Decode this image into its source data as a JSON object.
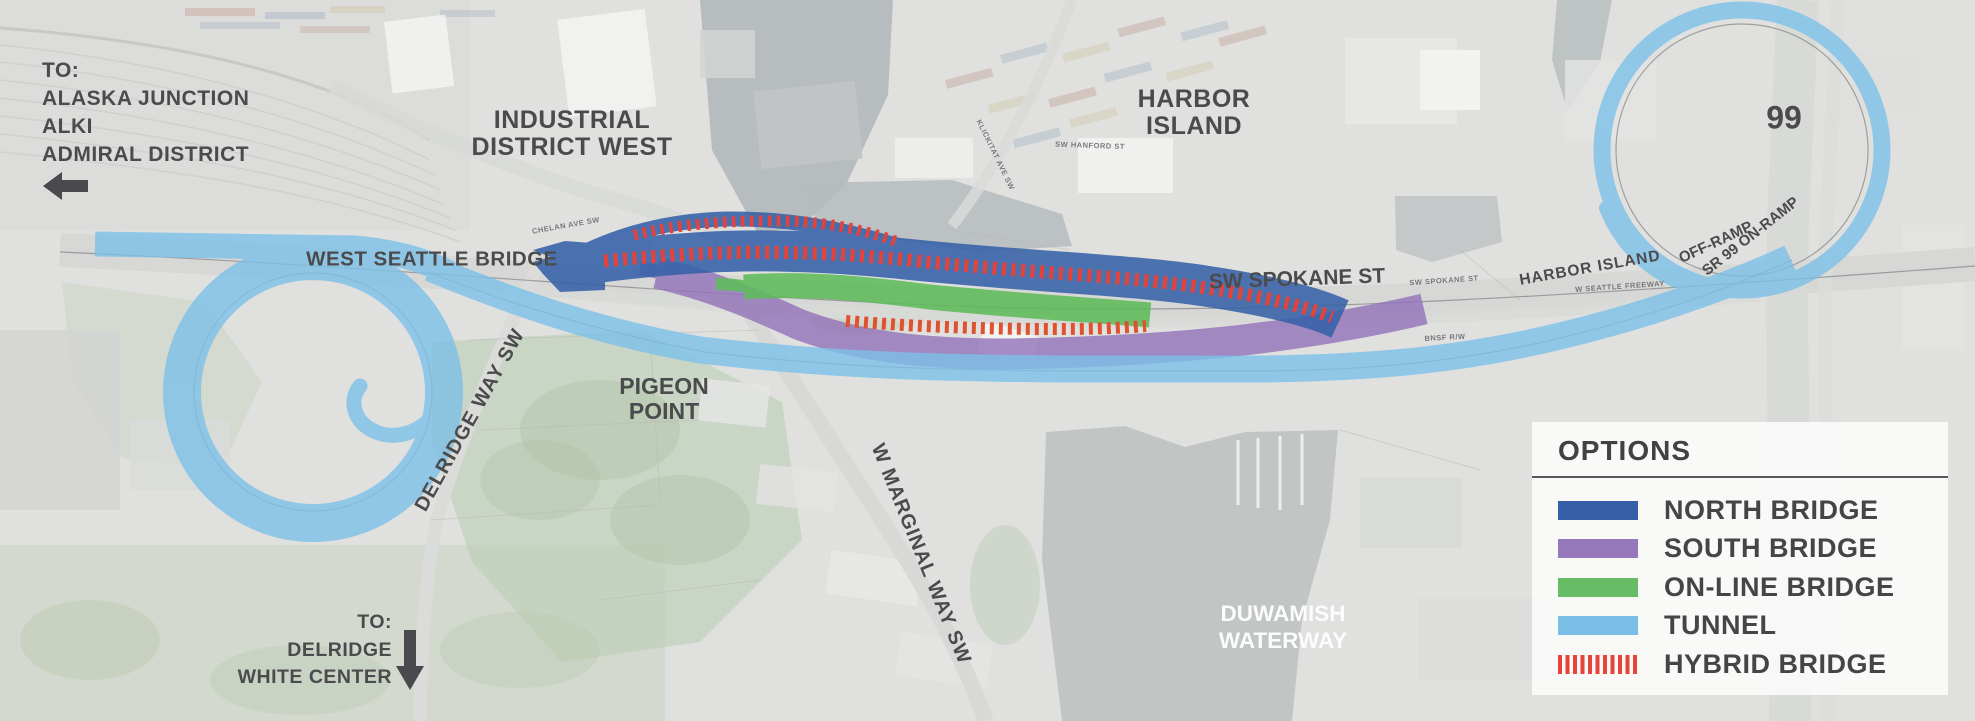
{
  "map": {
    "directions_northwest": {
      "line1": "TO:",
      "line2": "ALASKA JUNCTION",
      "line3": "ALKI",
      "line4": "ADMIRAL DISTRICT",
      "arrow_icon": "arrow-left-icon"
    },
    "directions_south": {
      "line1": "TO:",
      "line2": "DELRIDGE",
      "line3": "WHITE CENTER",
      "arrow_icon": "arrow-down-icon"
    },
    "areas": {
      "industrial_district_west": {
        "line1": "INDUSTRIAL",
        "line2": "DISTRICT WEST"
      },
      "harbor_island": {
        "line1": "HARBOR",
        "line2": "ISLAND"
      },
      "pigeon_point": {
        "line1": "PIGEON",
        "line2": "POINT"
      },
      "duwamish_waterway": {
        "line1": "DUWAMISH",
        "line2": "WATERWAY"
      }
    },
    "roads": {
      "west_seattle_bridge": "WEST SEATTLE BRIDGE",
      "sw_spokane_st": "SW SPOKANE ST",
      "harbor_island_ramp": "HARBOR ISLAND",
      "off_ramp": "OFF-RAMP",
      "sr99_on_ramp": "SR 99 ON-RAMP",
      "delridge_way_sw": "DELRIDGE WAY SW",
      "w_marginal_way_sw": "W MARGINAL WAY SW",
      "highway_99": "99"
    },
    "micro_labels": {
      "chelan": "CHELAN AVE SW",
      "klickitat": "KLICKITAT AVE SW",
      "hanford": "SW HANFORD ST",
      "spokane_small": "SW SPOKANE ST",
      "freeway_small": "W SEATTLE FREEWAY",
      "bnsf": "BNSF R/W"
    }
  },
  "legend": {
    "title": "OPTIONS",
    "items": [
      {
        "label": "NORTH BRIDGE",
        "color": "#3560a8",
        "swatch": "solid"
      },
      {
        "label": "SOUTH BRIDGE",
        "color": "#9578bb",
        "swatch": "solid"
      },
      {
        "label": "ON-LINE BRIDGE",
        "color": "#66bd66",
        "swatch": "solid"
      },
      {
        "label": "TUNNEL",
        "color": "#79bfe8",
        "swatch": "solid"
      },
      {
        "label": "HYBRID BRIDGE",
        "color": "#e8443a",
        "swatch": "stripes"
      }
    ]
  },
  "routes": {
    "north_bridge": {
      "name": "NORTH BRIDGE",
      "color": "#3560a8"
    },
    "south_bridge": {
      "name": "SOUTH BRIDGE",
      "color": "#9172b8"
    },
    "online_bridge": {
      "name": "ON-LINE BRIDGE",
      "color": "#5fbb5a"
    },
    "tunnel": {
      "name": "TUNNEL",
      "color": "#7cc0e8"
    },
    "hybrid_bridge": {
      "name": "HYBRID BRIDGE",
      "color": "#e5423a",
      "color_on_green": "#df5230"
    }
  }
}
